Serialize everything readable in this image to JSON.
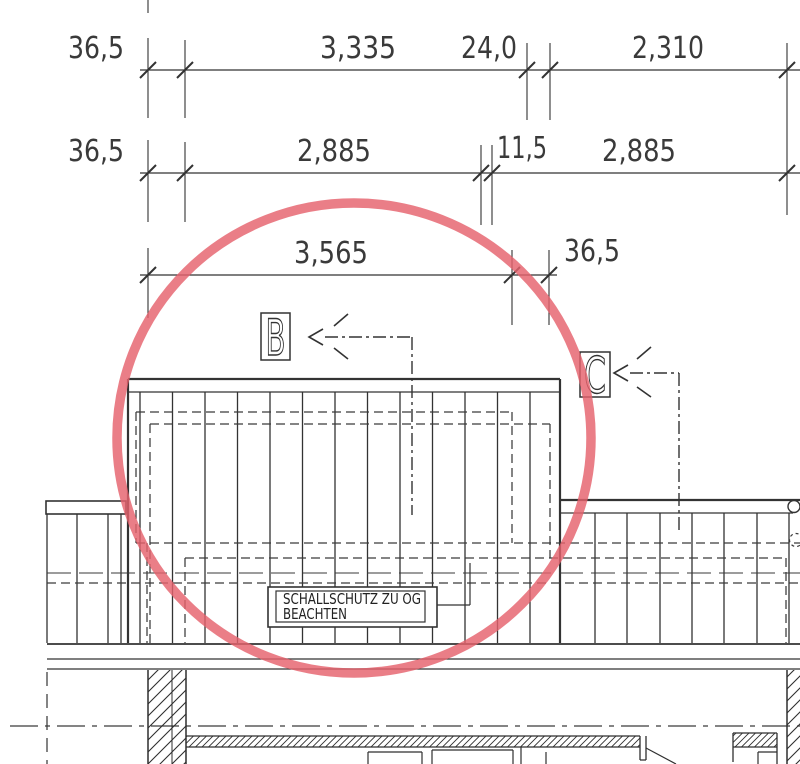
{
  "drawing": {
    "type": "architectural-plan-detail",
    "dims": {
      "row1": [
        "36,5",
        "3,335",
        "24,0",
        "2,310"
      ],
      "row2": [
        "36,5",
        "2,885",
        "11,5",
        "2,885"
      ],
      "row3": [
        "3,565",
        "36,5"
      ]
    },
    "markers": {
      "b": "B",
      "c": "C"
    },
    "note": {
      "line1": "SCHALLSCHUTZ ZU OG",
      "line2": "BEACHTEN"
    },
    "colors": {
      "line": "#333333",
      "dim_text": "#3a3a3a",
      "highlight": "#e5626c"
    }
  }
}
